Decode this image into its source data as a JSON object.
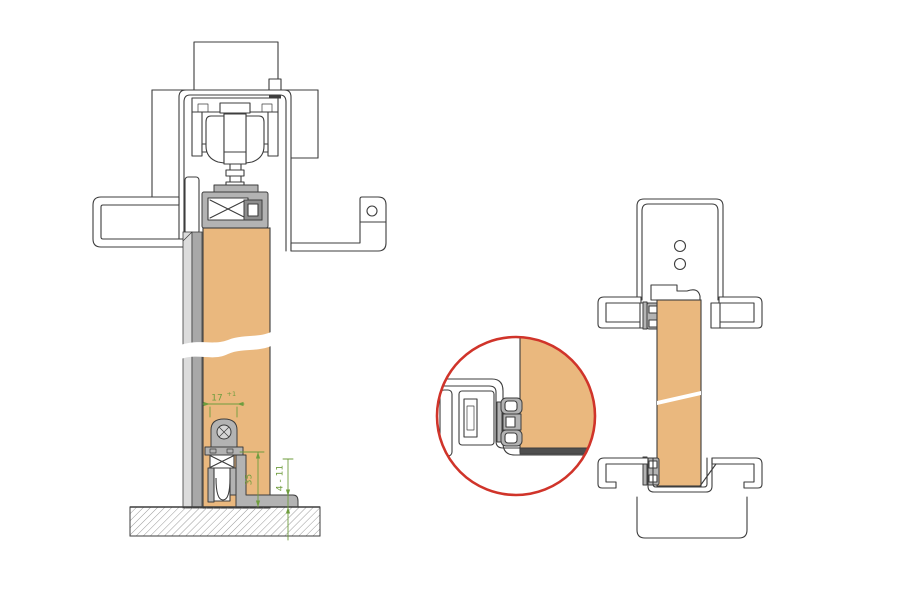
{
  "drawing": {
    "background_color": "#ffffff",
    "line_color": "#3d3d3d",
    "door_color": "#eab87e",
    "hardware_color": "#b3b3b3",
    "dimension_color": "#6f9d3e",
    "detail_ring_color": "#d0342a",
    "icons": {
      "adjustment_screw": "circle-x-icon",
      "screw_hole": "circle-icon"
    }
  },
  "vertical_section": {
    "dims": {
      "seal_width": {
        "value": "17",
        "tolerance": "+1"
      },
      "seal_height": {
        "value": "35"
      },
      "floor_gap": {
        "value": "4 - 11"
      }
    },
    "screw_hole_count": "1"
  },
  "horizontal_section": {
    "screw_hole_count": "2"
  }
}
